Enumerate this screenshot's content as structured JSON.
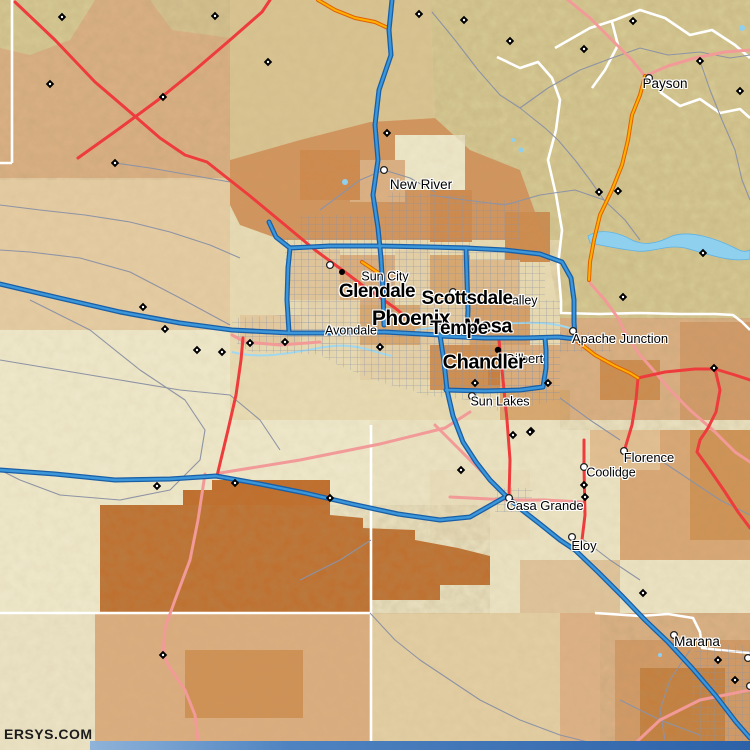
{
  "map": {
    "watermark": "ERSYS.COM",
    "labels": {
      "small": [
        {
          "id": "payson",
          "text": "Payson",
          "x": 665,
          "y": 84,
          "size": 13.5
        },
        {
          "id": "new-river",
          "text": "New River",
          "x": 421,
          "y": 185,
          "size": 13.5
        },
        {
          "id": "sun-city",
          "text": "Sun City",
          "x": 385,
          "y": 277,
          "size": 12.5
        },
        {
          "id": "valley",
          "text": "Valley",
          "x": 521,
          "y": 301,
          "size": 12.5
        },
        {
          "id": "avondale",
          "text": "Avondale",
          "x": 351,
          "y": 331,
          "size": 12.5
        },
        {
          "id": "gilbert",
          "text": "Gilbert",
          "x": 524,
          "y": 359,
          "size": 13
        },
        {
          "id": "apache-junction",
          "text": "Apache Junction",
          "x": 620,
          "y": 339,
          "size": 13
        },
        {
          "id": "sun-lakes",
          "text": "Sun Lakes",
          "x": 500,
          "y": 402,
          "size": 12.5
        },
        {
          "id": "casa-grande",
          "text": "Casa Grande",
          "x": 545,
          "y": 506,
          "size": 13
        },
        {
          "id": "coolidge",
          "text": "Coolidge",
          "x": 611,
          "y": 473,
          "size": 12.5
        },
        {
          "id": "florence",
          "text": "Florence",
          "x": 649,
          "y": 458,
          "size": 13
        },
        {
          "id": "eloy",
          "text": "Eloy",
          "x": 584,
          "y": 546,
          "size": 13
        },
        {
          "id": "marana",
          "text": "Marana",
          "x": 697,
          "y": 642,
          "size": 13.5
        }
      ],
      "large": [
        {
          "id": "glendale",
          "text": "Glendale",
          "x": 377,
          "y": 293,
          "size": 19
        },
        {
          "id": "scottsdale",
          "text": "Scottsdale",
          "x": 467,
          "y": 300,
          "size": 19
        },
        {
          "id": "phoenix",
          "text": "Phoenix",
          "x": 411,
          "y": 320,
          "size": 21
        },
        {
          "id": "mesa",
          "text": "Mesa",
          "x": 488,
          "y": 328,
          "size": 20
        },
        {
          "id": "tempe",
          "text": "Tempe",
          "x": 459,
          "y": 330,
          "size": 19
        },
        {
          "id": "chandler",
          "text": "Chandler",
          "x": 484,
          "y": 364,
          "size": 20
        }
      ]
    },
    "palette": {
      "freeway_blue": "#3b97da",
      "freeway_casing": "#1a5fa6",
      "highway_red": "#ee3b3c",
      "road_pink": "#f29a98",
      "road_orange": "#ffb000",
      "road_gray": "#8d93a4",
      "boundary_white": "#ffffff",
      "water_blue": "#8fd0ef",
      "terrain_cream": "#efe9cb",
      "terrain_tan": "#dcae82",
      "terrain_khaki": "#d8cb94",
      "terrain_orange": "#d2955e",
      "terrain_dark_orange": "#c06e2c",
      "footer_blue": "#2d62a8",
      "label_color": "#000000"
    }
  }
}
